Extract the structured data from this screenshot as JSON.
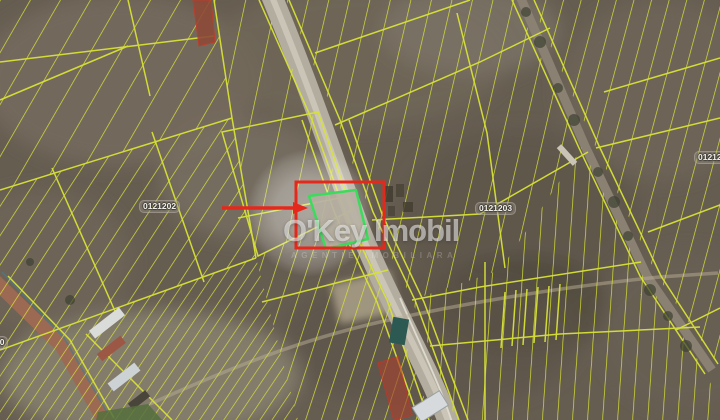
{
  "watermark": {
    "brand": "O'Key Imobil",
    "tagline": "AGENTIE IMOBILIARA"
  },
  "cadastral_labels": {
    "left": "0121202",
    "center_right": "0121203",
    "far_right": "0121204",
    "edge_left": "10"
  },
  "highlight": {
    "parcel_outline_color": "#3bdc5c",
    "selection_box_color": "#e6281c",
    "arrow_color": "#e6281c"
  },
  "map_colors": {
    "parcel_lines": "#d8e236",
    "terrain": "#665d51",
    "main_road": "#b3ada0",
    "dirt_road": "#9c6a52"
  }
}
